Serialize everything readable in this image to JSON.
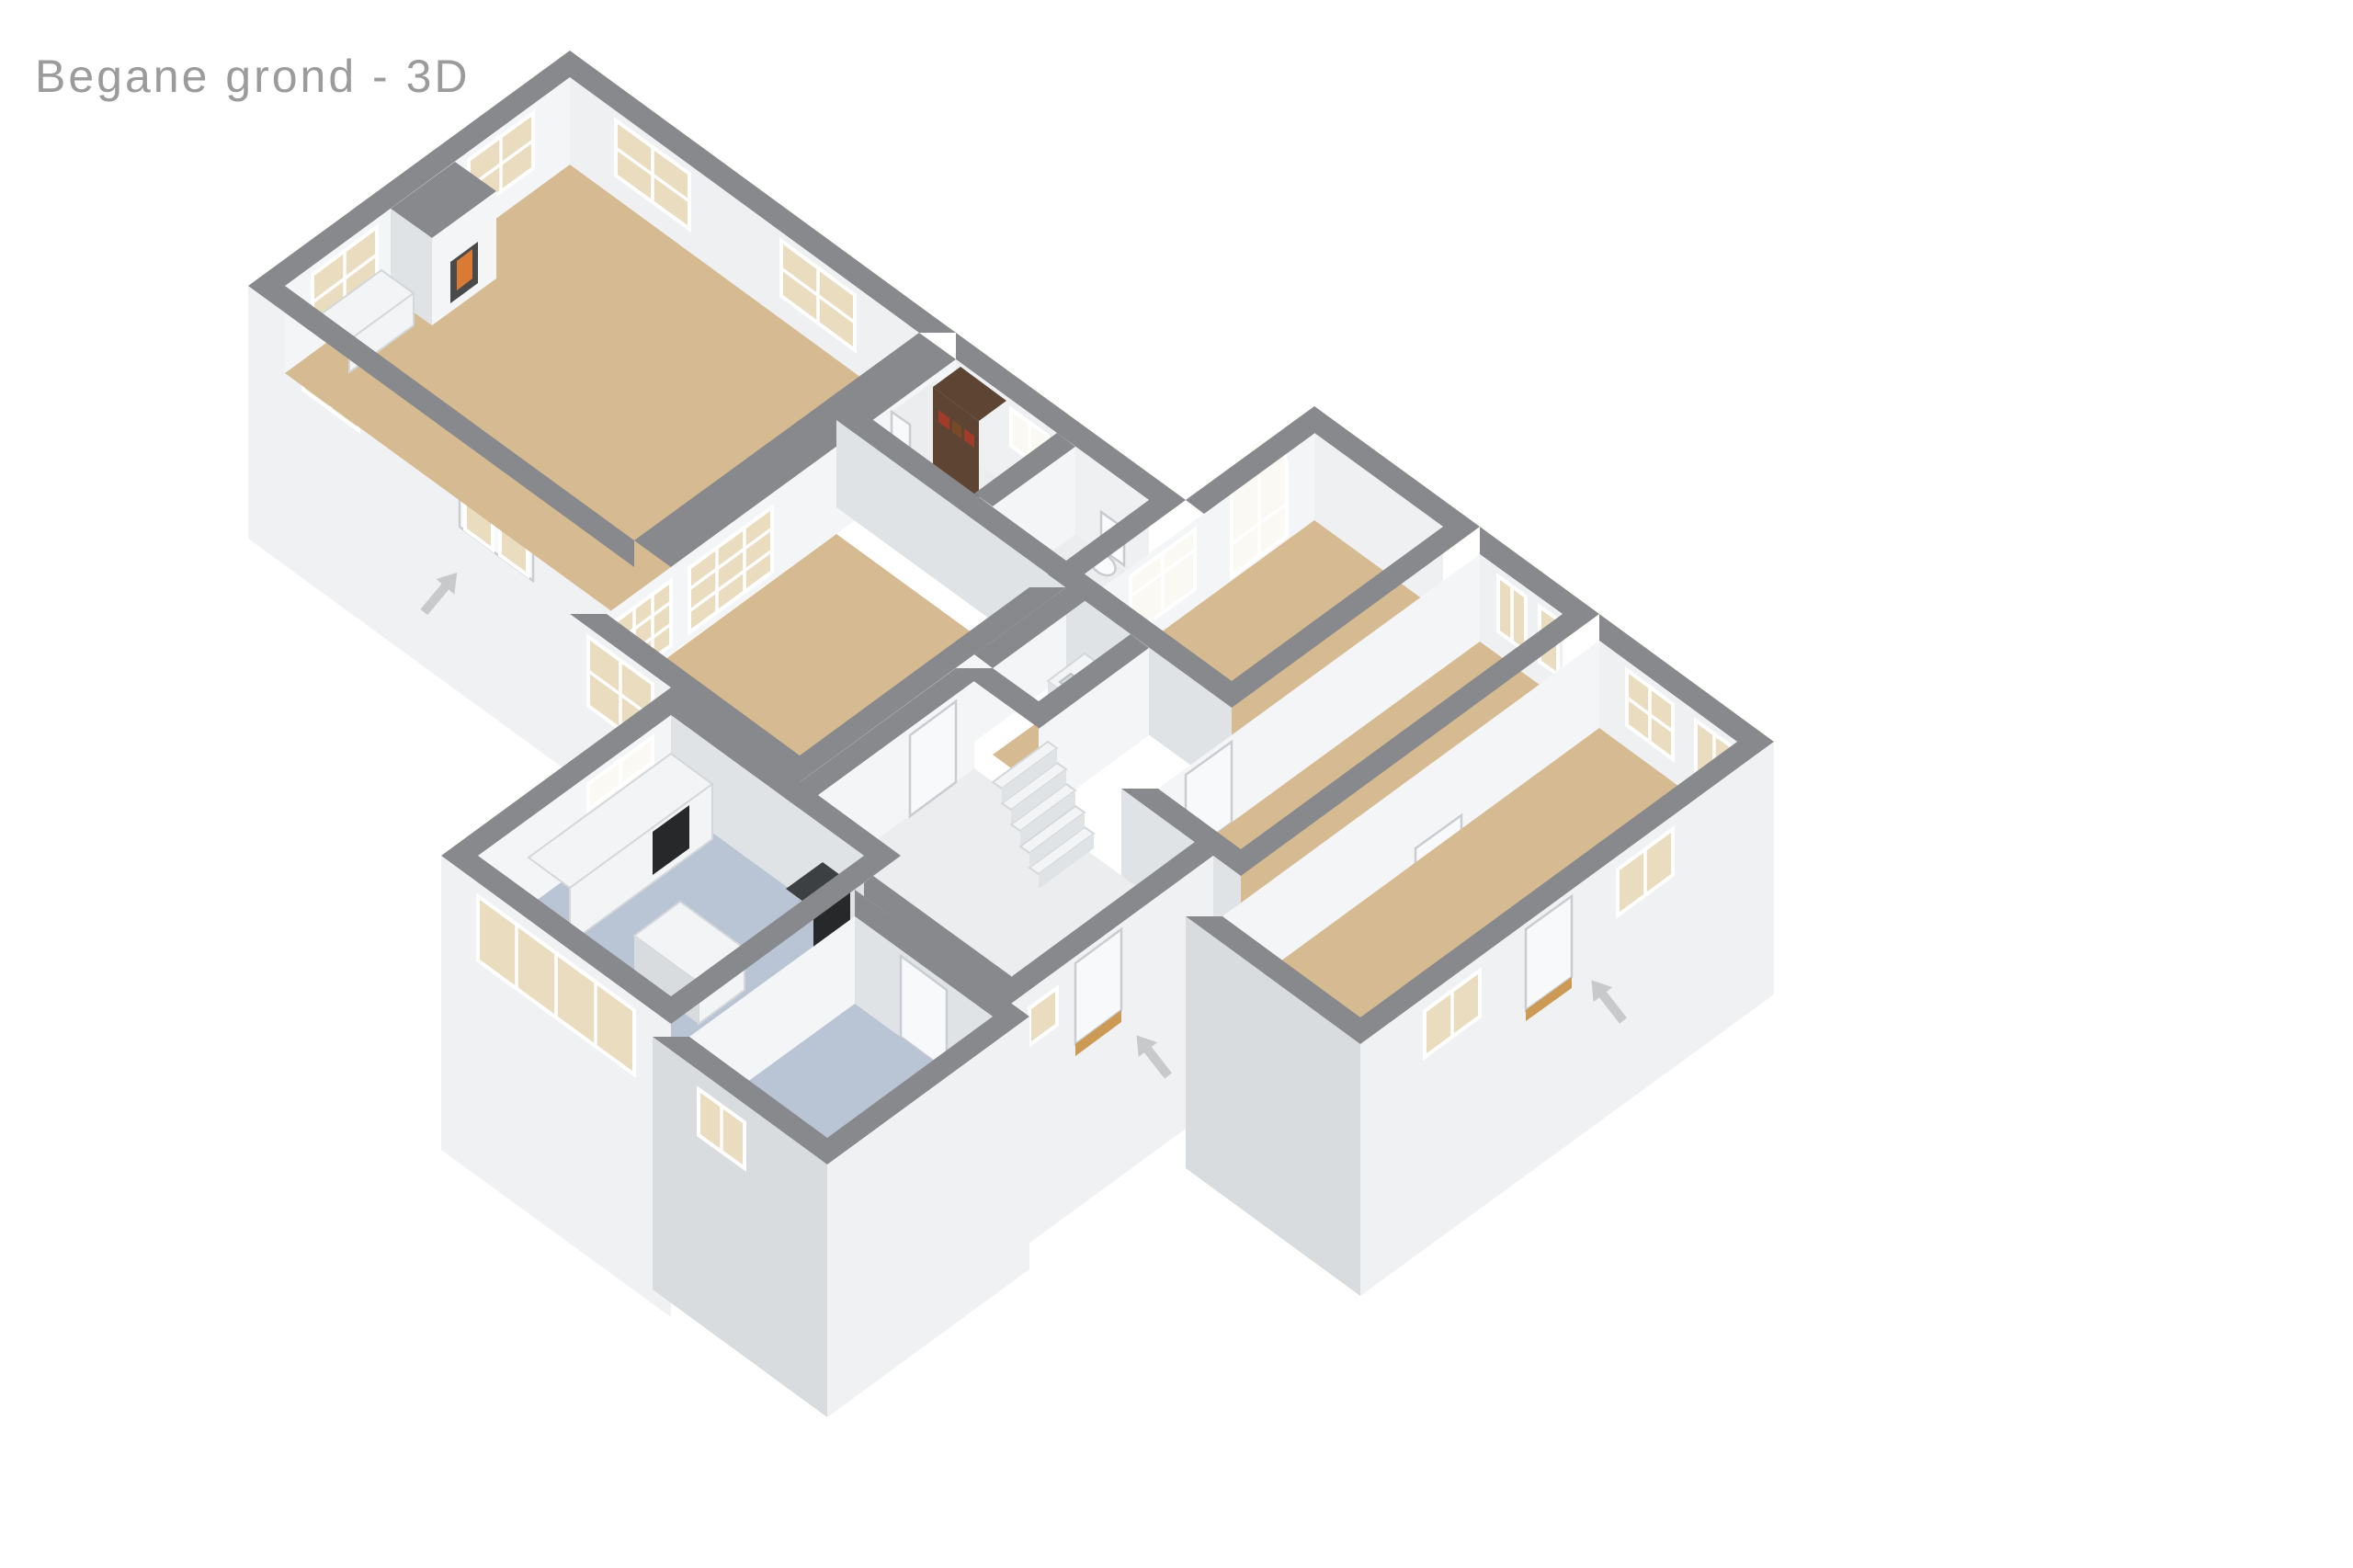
{
  "title": "Begane grond - 3D",
  "colors": {
    "background": "#ffffff",
    "title_text": "#9b9b9b",
    "wall_cap": "#87898c",
    "wall_face_se": "#f4f5f6",
    "wall_face_sw": "#dfe3e6",
    "wall_face_ne": "#eef0f1",
    "exterior_face": "#f0f1f2",
    "exterior_face_shade": "#d9dcde",
    "floor_tan": "#d6ba92",
    "floor_blue": "#b9c4d4",
    "floor_light": "#ebedee",
    "glass_warm": "#eadcbf",
    "glass_bright": "#faf9f4",
    "window_frame": "#ffffff",
    "door_white": "#f8f9fa",
    "door_frame": "#c9cdd1",
    "threshold_tan": "#cc9a55",
    "fire_orange": "#d97b35",
    "firebox_dark": "#4a4a4a",
    "furniture_white": "#f3f4f5",
    "appliance_black": "#26282a",
    "stove_dark": "#3d4043",
    "bookshelf_brown": "#5d4433",
    "book_red": "#a33b2a",
    "arrow_gray": "#c7c9cb",
    "fixture_white": "#fafbfc",
    "fixture_stroke": "#c8ccd0"
  },
  "arrows": [
    {
      "name": "terrace-entrance-arrow",
      "direction": "up-right"
    },
    {
      "name": "bedroom-entrance-arrow",
      "direction": "up-left"
    },
    {
      "name": "front-entrance-arrow",
      "direction": "up-left"
    }
  ]
}
